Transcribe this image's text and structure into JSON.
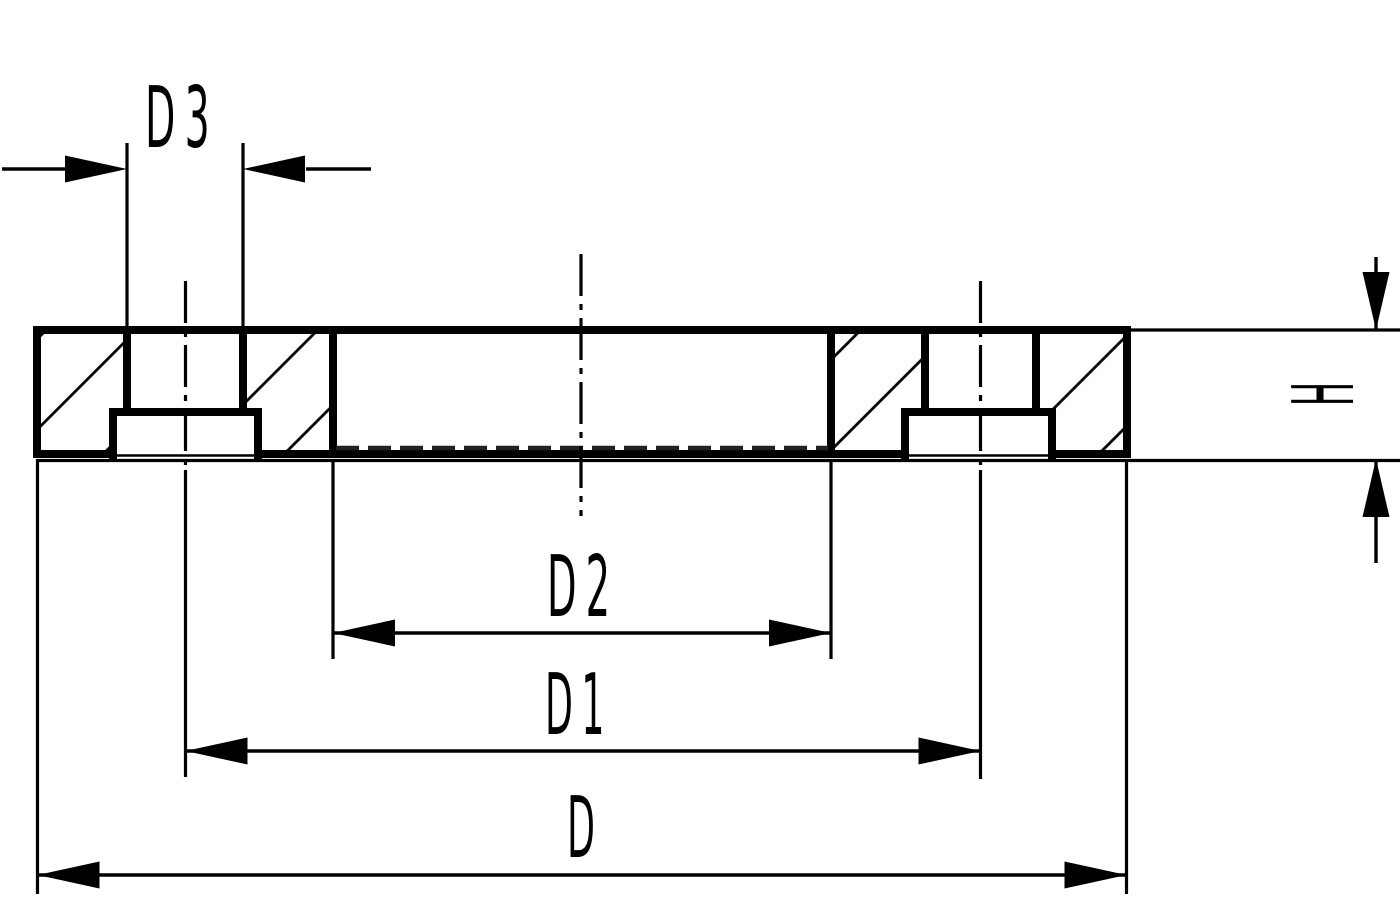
{
  "drawing": {
    "labels": {
      "d3": "D3",
      "d2": "D2",
      "d1": "D1",
      "d": "D",
      "h": "H"
    },
    "colors": {
      "line": "#000000",
      "hidden_line": "#222222",
      "background": "#ffffff"
    }
  }
}
